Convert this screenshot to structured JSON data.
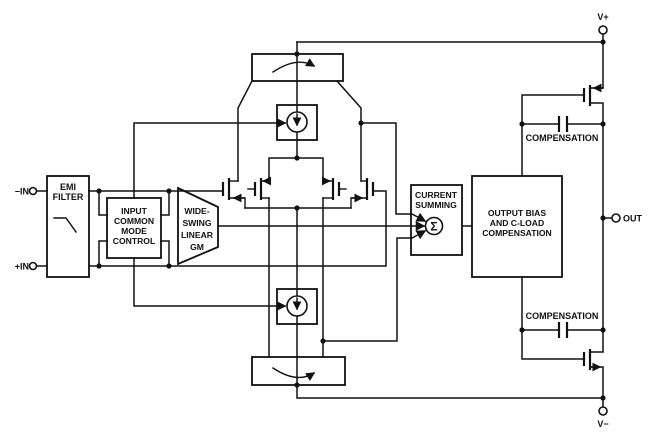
{
  "terminals": {
    "in_neg": "−IN",
    "in_pos": "+IN",
    "v_plus": "V+",
    "v_minus": "V−",
    "out": "OUT"
  },
  "blocks": {
    "emi_filter": {
      "lines": [
        "EMI",
        "FILTER"
      ]
    },
    "input_common_mode_control": {
      "lines": [
        "INPUT",
        "COMMON",
        "MODE",
        "CONTROL"
      ]
    },
    "wide_swing_linear_gm": {
      "lines": [
        "WIDE-",
        "SWING",
        "LINEAR",
        "GM"
      ]
    },
    "current_summing": {
      "lines": [
        "CURRENT",
        "SUMMING"
      ],
      "sigma_symbol": "Σ"
    },
    "output_bias": {
      "lines": [
        "OUTPUT BIAS",
        "AND C-LOAD",
        "COMPENSATION"
      ]
    },
    "compensation_top": {
      "label": "COMPENSATION"
    },
    "compensation_bottom": {
      "label": "COMPENSATION"
    }
  },
  "colors": {
    "line": "#111111",
    "background": "#ffffff"
  }
}
